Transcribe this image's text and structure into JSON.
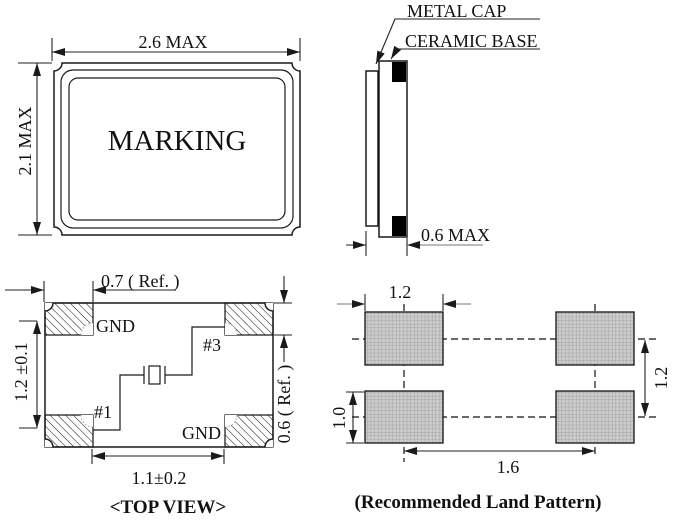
{
  "front_view": {
    "marking": "MARKING",
    "dim_width": "2.6 MAX",
    "dim_height": "2.1 MAX"
  },
  "side_view": {
    "label_metal_cap": "METAL CAP",
    "label_ceramic_base": "CERAMIC BASE",
    "dim_thickness": "0.6 MAX"
  },
  "top_view": {
    "caption": "<TOP VIEW>",
    "dim_pad_width": "0.7 ( Ref. )",
    "dim_pad_gap": "1.2 ±0.1",
    "dim_pad_height": "0.6 ( Ref. )",
    "dim_inner_span": "1.1±0.2",
    "pad_labels": {
      "top_left": "GND",
      "top_right": "#3",
      "bottom_left": "#1",
      "bottom_right": "GND"
    }
  },
  "land_pattern": {
    "caption": "(Recommended Land Pattern)",
    "dim_pad_width": "1.2",
    "dim_row_pitch": "1.2",
    "dim_pad_height": "1.0",
    "dim_col_pitch": "1.6"
  },
  "colors": {
    "line": "#1a1a1a",
    "pad_fill": "#cbcbcb",
    "pad_grid": "#989898",
    "background": "#ffffff"
  }
}
